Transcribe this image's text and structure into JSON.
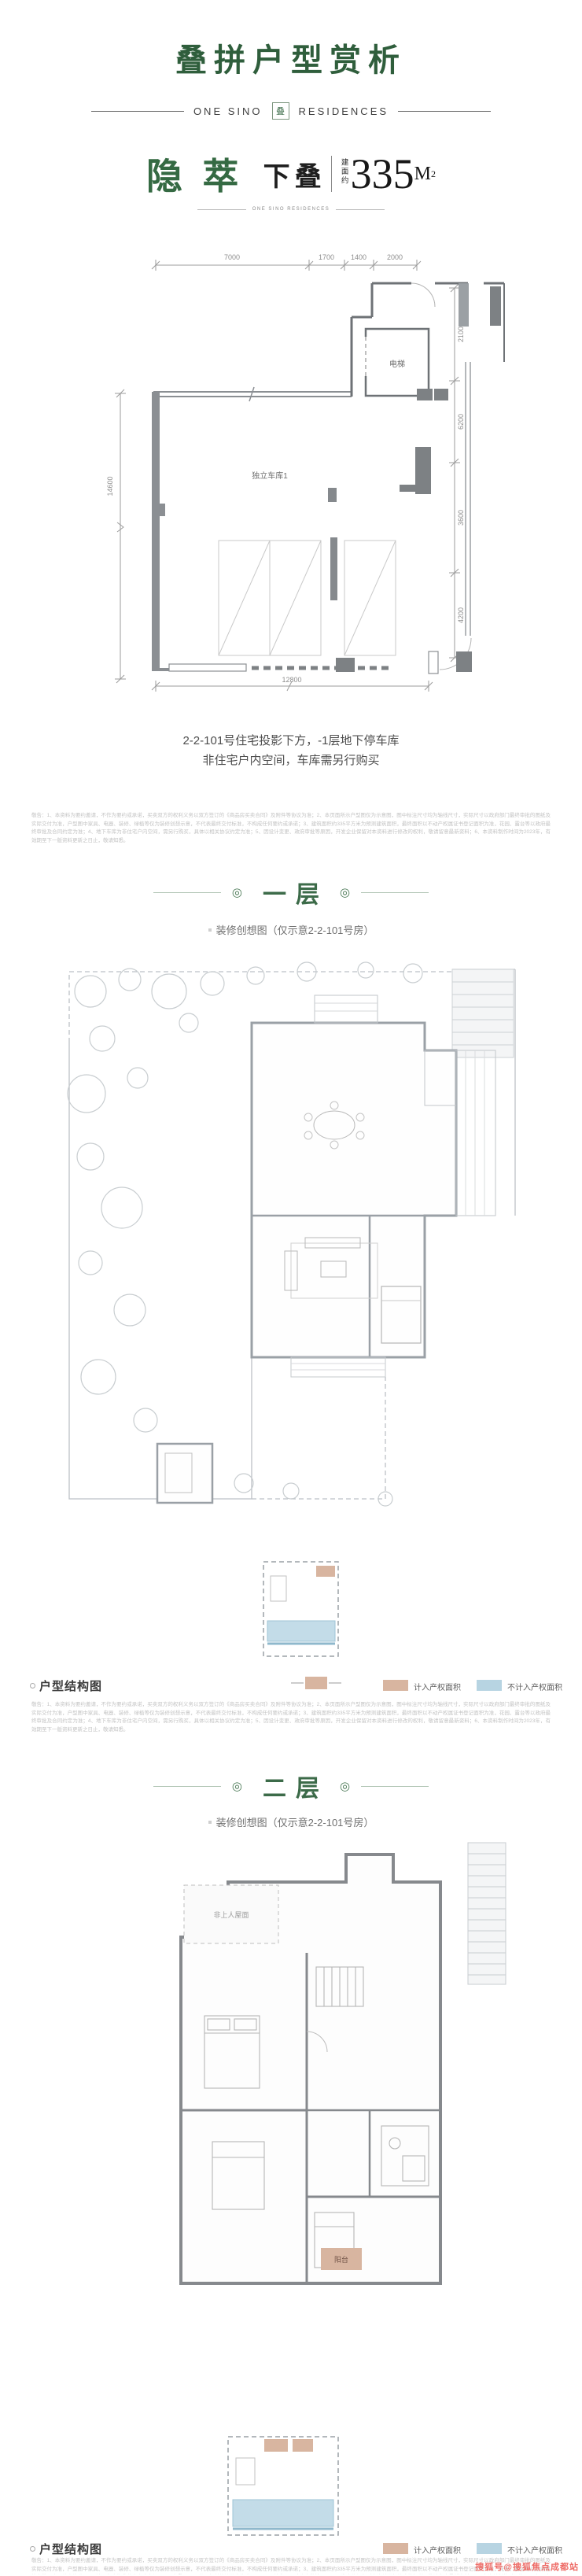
{
  "header": {
    "title": "叠拼户型赏析",
    "brand_left": "ONE SINO",
    "brand_right": "RESIDENCES",
    "seal_char": "叠"
  },
  "unit": {
    "name": "隐萃",
    "type_label": "下叠",
    "area_prefix": "建面约",
    "area_value": "335",
    "area_unit": "M",
    "area_sup": "2",
    "brand_small": "ONE SINO RESIDENCES"
  },
  "basement": {
    "dims": {
      "top": [
        "7000",
        "1700",
        "1400",
        "2000"
      ],
      "right": [
        "2100",
        "6200",
        "3600",
        "4200"
      ],
      "left": "14600",
      "bottom": "12800"
    },
    "labels": {
      "elevator": "电梯",
      "garage": "独立车库1"
    },
    "caption_line1": "2-2-101号住宅投影下方，-1层地下停车库",
    "caption_line2": "非住宅户内空间，车库需另行购买"
  },
  "sections": {
    "floor1": {
      "title": "一层",
      "subtitle": "装修创想图（仅示意2-2-101号房）",
      "ornament": "◎"
    },
    "floor2": {
      "title": "二层",
      "subtitle": "装修创想图（仅示意2-2-101号房）",
      "ornament": "◎"
    }
  },
  "floor2_labels": {
    "roof": "非上人屋面",
    "balcony": "阳台"
  },
  "legend": {
    "title": "户型结构图",
    "items": [
      {
        "label": "计入产权面积",
        "color": "#d8b5a0"
      },
      {
        "label": "不计入产权面积",
        "color": "#b7d4e2"
      }
    ]
  },
  "disclaimer": {
    "text": "敬告：1、本资料为要约邀请，不作为要约或承诺，买卖双方的权利义务以双方签订的《商品房买卖合同》及附件等协议为准；2、本页面所示户型图仅为示意图，图中标注尺寸均为轴线尺寸，实际尺寸以政府部门最终审批的图纸及实际交付为准，户型图中家具、电器、装修、绿植等仅为装修创想示意，不代表最终交付标准，不构成任何要约或承诺；3、建筑面积约335平方米为预测建筑面积，最终面积以不动产权属证书登记面积为准，花园、露台等以政府最终审批及合同约定为准；4、地下车库为非住宅户内空间，需另行购买，具体以相关协议约定为准；5、因设计变更、政府审批等原因，开发企业保留对本资料进行修改的权利，敬请留意最新资料；6、本资料制作时间为2023年，有效期至下一版资料更新之日止，敬请知悉。"
  },
  "watermark": {
    "text": "搜狐号@搜狐焦点成都站",
    "color": "#ee6b66"
  },
  "colors": {
    "brand_green": "#2f5e3c",
    "accent_green": "#3c6b49",
    "wall_gray": "#8b8f93",
    "pool_blue": "#c3dce8",
    "tan": "#d8b5a0"
  }
}
